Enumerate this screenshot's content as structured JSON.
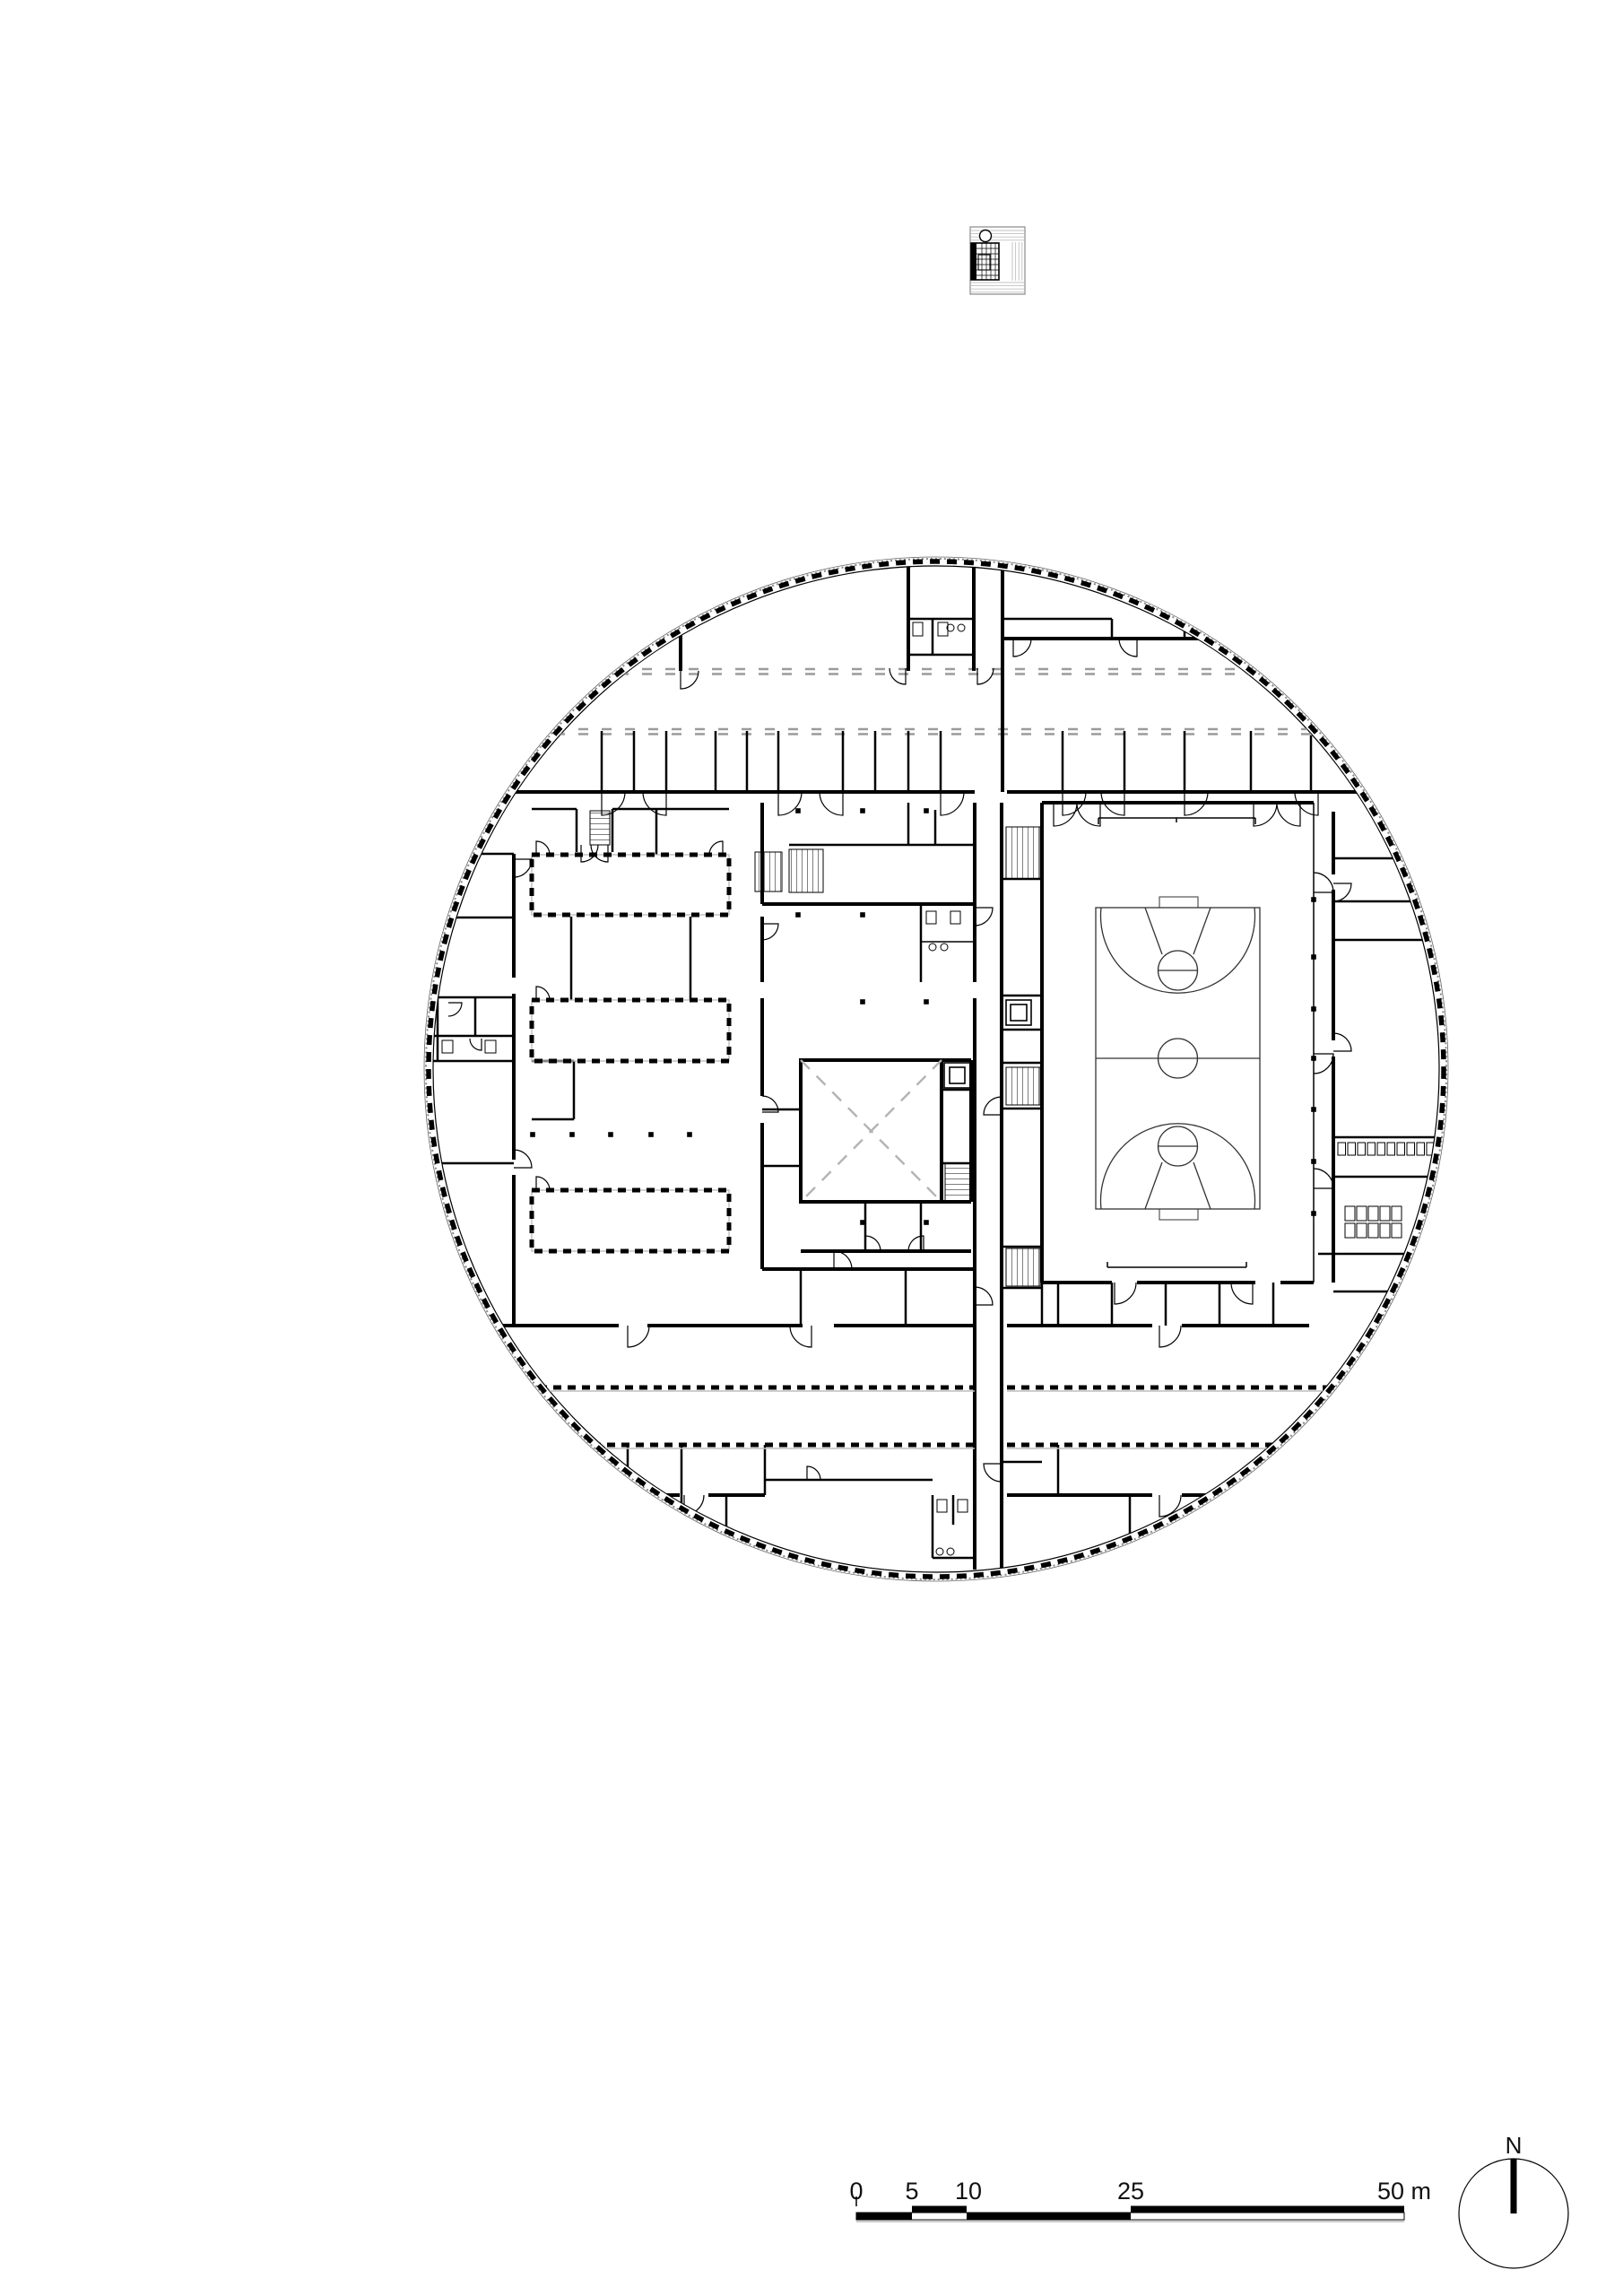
{
  "page": {
    "background": "#ffffff"
  },
  "colors": {
    "ink": "#000000",
    "roof_dash_grey": "#9b9b9b",
    "light_grey": "#c4c4c4",
    "mid_grey": "#8a8a8a"
  },
  "scale_bar": {
    "tick_0": "0",
    "tick_5": "5",
    "tick_10": "10",
    "tick_25": "25",
    "tick_50": "50 m"
  },
  "north_arrow": {
    "label": "N"
  }
}
